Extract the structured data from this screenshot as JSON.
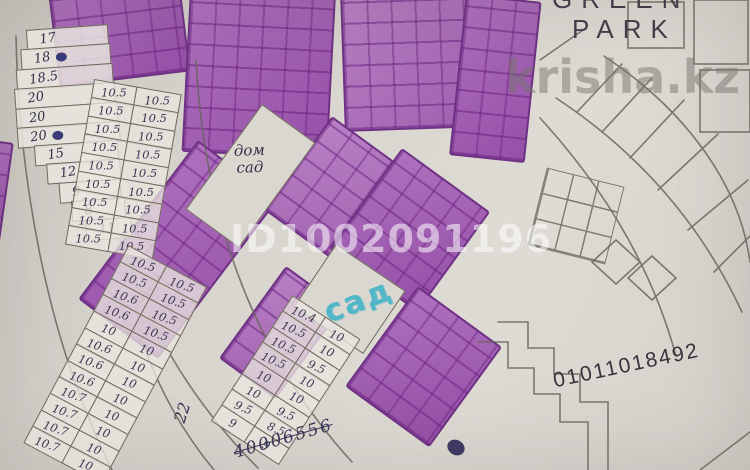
{
  "watermarks": {
    "listing_id": "ID1002091196",
    "site": "krisha.kz"
  },
  "labels": {
    "complex_line1": "GREEN",
    "complex_line2": "PARK",
    "cadastre_number": "01011018492",
    "house_garden_line1": "дом",
    "house_garden_line2": "сад",
    "garden": "сад",
    "side_note": "22",
    "crossed_note": "40006556"
  },
  "plots": {
    "left_fan": [
      {
        "v": "17"
      },
      {
        "v": "18",
        "dot": true
      },
      {
        "v": "18.5"
      },
      {
        "v": "20"
      },
      {
        "v": "20"
      },
      {
        "v": "20",
        "dot": true
      }
    ],
    "left_wedge": [
      {
        "v": "15"
      },
      {
        "v": "12"
      },
      {
        "v": "9"
      },
      {
        "v": "8"
      },
      {
        "v": "11"
      }
    ],
    "arc_upper_rows": [
      {
        "l": "10.5",
        "r": "10.5"
      },
      {
        "l": "10.5",
        "r": "10.5"
      },
      {
        "l": "10.5",
        "r": "10.5"
      },
      {
        "l": "10.5",
        "r": "10.5"
      },
      {
        "l": "10.5",
        "r": "10.5"
      },
      {
        "l": "10.5",
        "r": "10.5"
      },
      {
        "l": "10.5",
        "r": "10.5"
      },
      {
        "l": "10.5",
        "r": "10.5"
      },
      {
        "l": "10.5",
        "r": "10.5"
      }
    ],
    "arc_lower_rows": [
      {
        "l": "10.5",
        "r": "10.5"
      },
      {
        "l": "10.5",
        "r": "10.5"
      },
      {
        "l": "10.6",
        "r": "10.5"
      },
      {
        "l": "10.6",
        "r": "10.5"
      },
      {
        "l": "10",
        "r": "10"
      },
      {
        "l": "10.6",
        "r": "10"
      },
      {
        "l": "10.6",
        "r": "10"
      },
      {
        "l": "10.6",
        "r": "10"
      },
      {
        "l": "10.7",
        "r": "10"
      },
      {
        "l": "10.7",
        "r": "10"
      },
      {
        "l": "10.7",
        "r": "10"
      },
      {
        "l": "10.7",
        "r": "10"
      }
    ],
    "mid_cluster_rows": [
      {
        "l": "10.4",
        "r": "10"
      },
      {
        "l": "10.5",
        "r": "10"
      },
      {
        "l": "10.5",
        "r": "9.5"
      },
      {
        "l": "10.5",
        "r": "10"
      },
      {
        "l": "10",
        "r": "10"
      },
      {
        "l": "10",
        "r": "9.5"
      },
      {
        "l": "9.5",
        "r": "8.5"
      },
      {
        "l": "9",
        "r": "9"
      }
    ]
  }
}
